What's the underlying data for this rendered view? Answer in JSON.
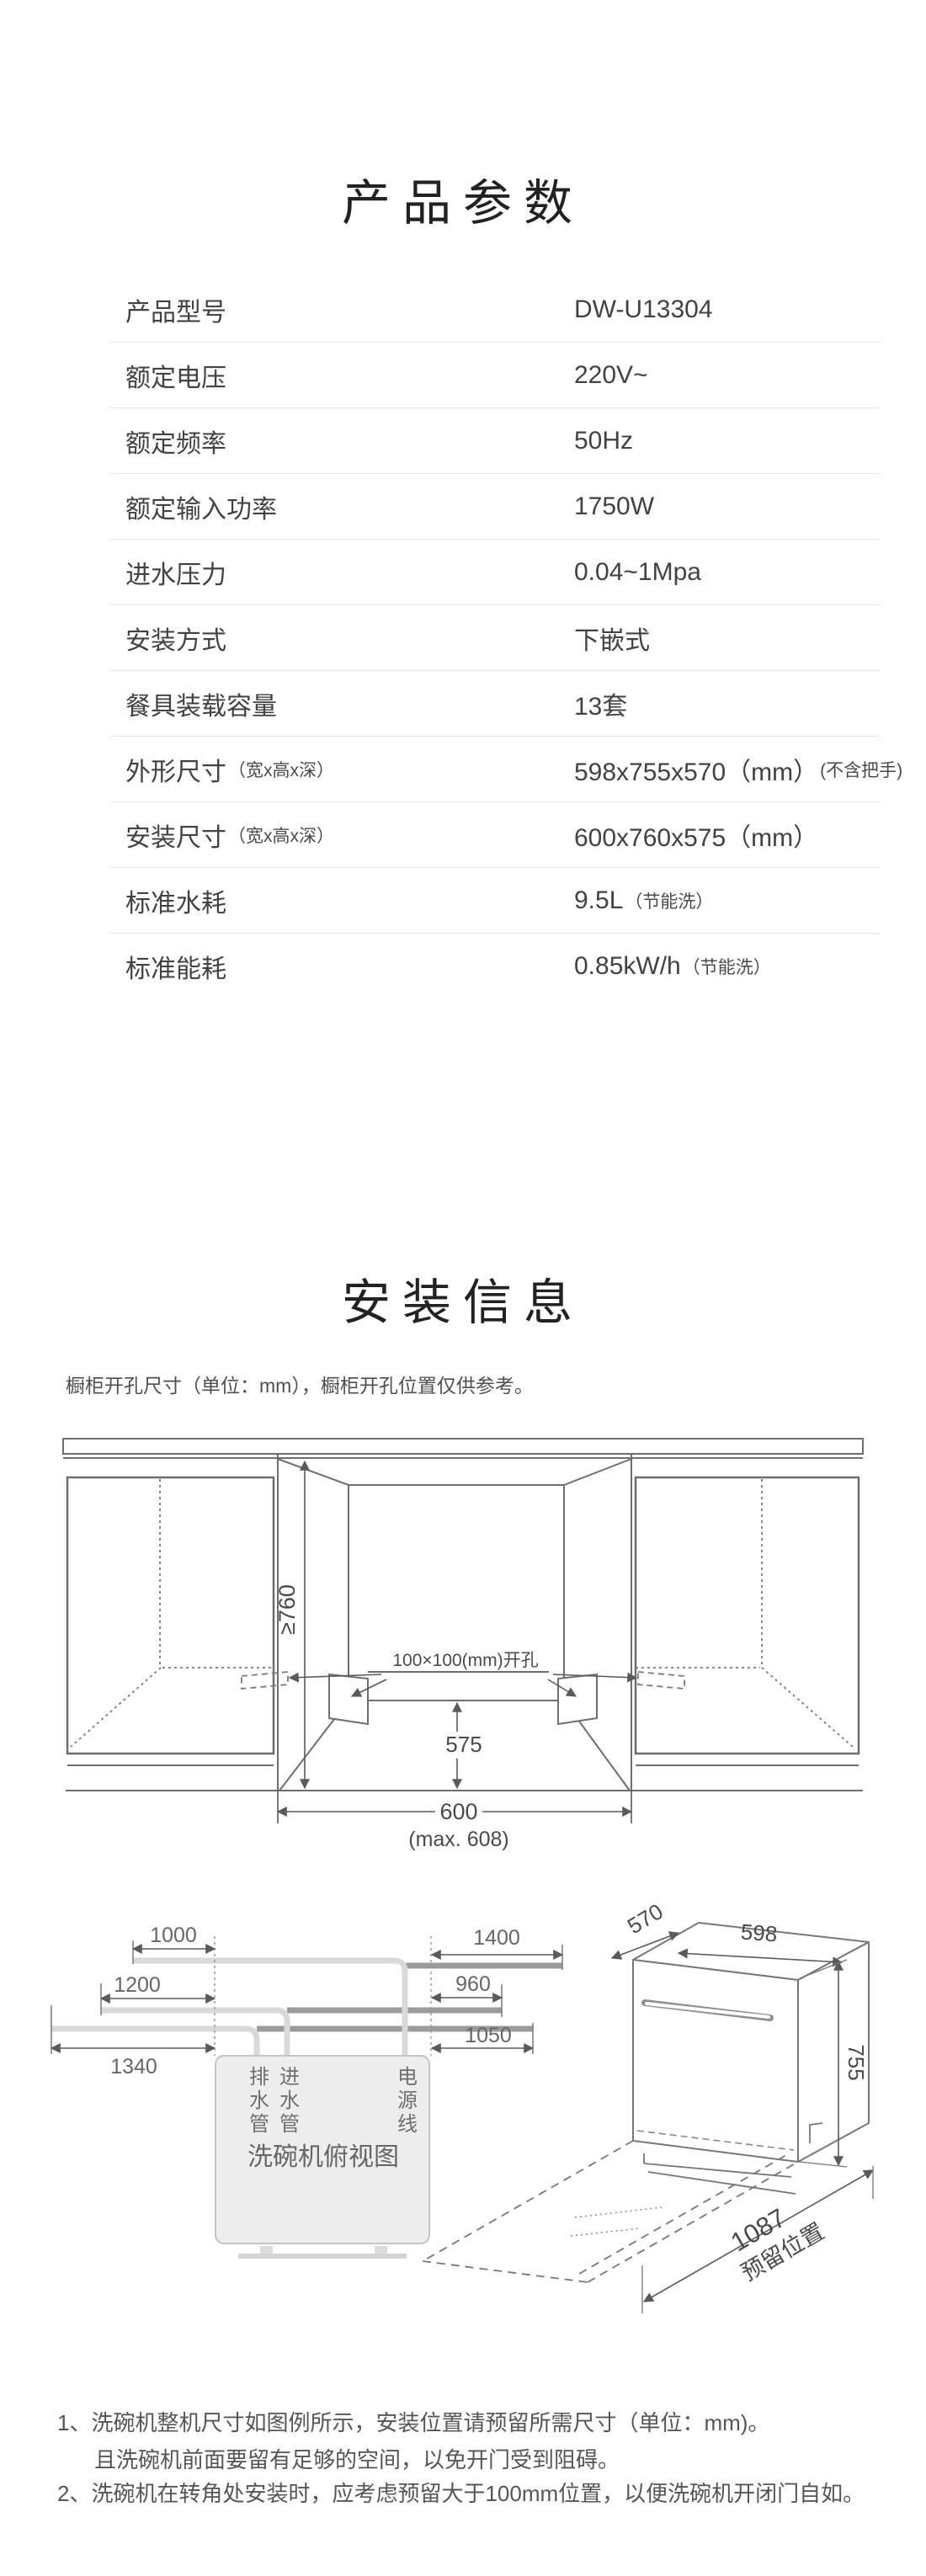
{
  "specs": {
    "title": "产品参数",
    "rows": [
      {
        "label": "产品型号",
        "value": "DW-U13304"
      },
      {
        "label": "额定电压",
        "value": "220V~"
      },
      {
        "label": "额定频率",
        "value": "50Hz"
      },
      {
        "label": "额定输入功率",
        "value": "1750W"
      },
      {
        "label": "进水压力",
        "value": "0.04~1Mpa"
      },
      {
        "label": "安装方式",
        "value": "下嵌式"
      },
      {
        "label": "餐具装载容量",
        "value": "13套"
      },
      {
        "label": "外形尺寸",
        "label_small": "（宽x高x深）",
        "value": "598x755x570（mm）",
        "value_small": "(不含把手)"
      },
      {
        "label": "安装尺寸",
        "label_small": "（宽x高x深）",
        "value": "600x760x575（mm）"
      },
      {
        "label": "标准水耗",
        "value": "9.5L",
        "value_small": "（节能洗）"
      },
      {
        "label": "标准能耗",
        "value": "0.85kW/h",
        "value_small": "（节能洗）"
      }
    ]
  },
  "install": {
    "title": "安装信息",
    "note": "橱柜开孔尺寸（单位：mm），橱柜开孔位置仅供参考。",
    "cabinet_diagram": {
      "height_dim": "≥760",
      "hole_label": "100×100(mm)开孔",
      "depth_dim": "575",
      "width_dim": "600",
      "width_max": "(max. 608)"
    },
    "topview_diagram": {
      "dim_1000": "1000",
      "dim_1200": "1200",
      "dim_1340": "1340",
      "dim_1400": "1400",
      "dim_960": "960",
      "dim_1050": "1050",
      "drain_label": "排水管",
      "inlet_label": "进水管",
      "power_label": "电源线",
      "box_label": "洗碗机俯视图"
    },
    "machine_diagram": {
      "dim_depth": "570",
      "dim_width": "598",
      "dim_height": "755",
      "dim_reserve": "1087",
      "reserve_label": "预留位置"
    }
  },
  "footnotes": {
    "note1_line1": "1、洗碗机整机尺寸如图例所示，安装位置请预留所需尺寸（单位：mm)。",
    "note1_line2": "且洗碗机前面要留有足够的空间，以免开门受到阻碍。",
    "note2": "2、洗碗机在转角处安装时，应考虑预留大于100mm位置，以便洗碗机开闭门自如。"
  }
}
